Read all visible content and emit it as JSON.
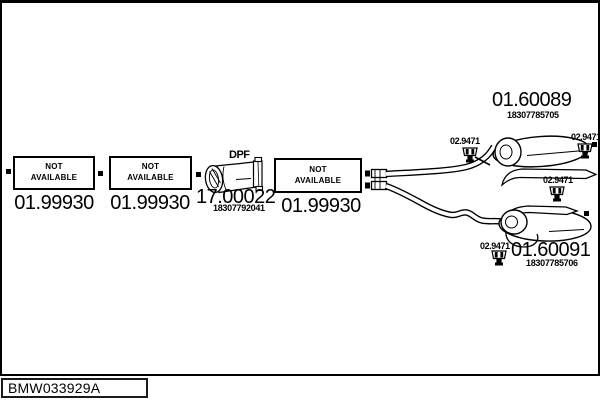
{
  "colors": {
    "ink": "#000000",
    "background": "#ffffff"
  },
  "parts": {
    "front_boxes": [
      {
        "na_line1": "NOT",
        "na_line2": "AVAILABLE",
        "part_number": "01.99930"
      },
      {
        "na_line1": "NOT",
        "na_line2": "AVAILABLE",
        "part_number": "01.99930"
      },
      {
        "na_line1": "NOT",
        "na_line2": "AVAILABLE",
        "part_number": "01.99930"
      }
    ],
    "dpf": {
      "tag": "DPF",
      "part_number": "17.00022",
      "oem_number": "18307792041"
    },
    "rear_muffler_upper": {
      "part_number": "01.60089",
      "oem_number": "18307785705"
    },
    "rear_muffler_lower": {
      "part_number": "01.60091",
      "oem_number": "18307785706"
    },
    "hangers": [
      {
        "part_number": "02.9471"
      },
      {
        "part_number": "02.9471"
      },
      {
        "part_number": "02.9471"
      },
      {
        "part_number": "02.9471"
      }
    ]
  },
  "footer": {
    "drawing_ref": "BMW033929A"
  }
}
